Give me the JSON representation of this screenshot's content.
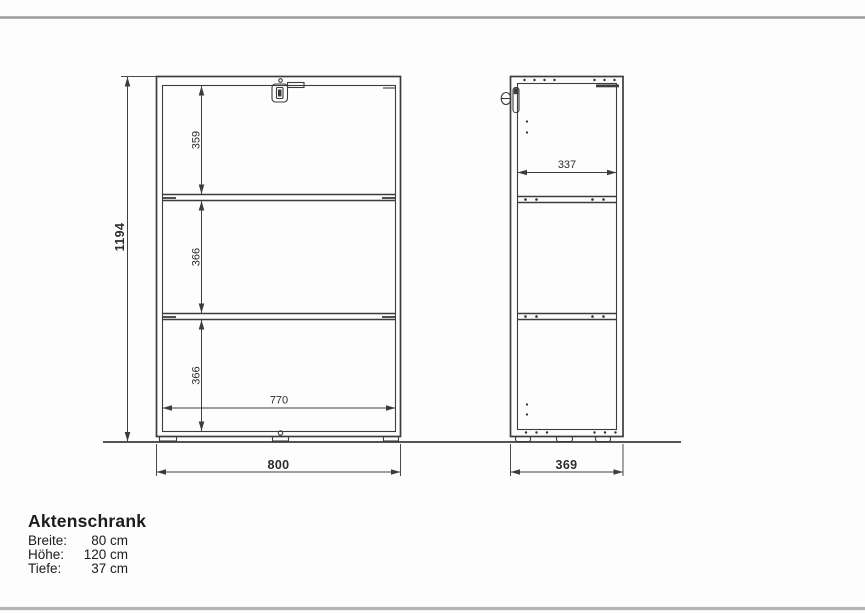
{
  "front": {
    "overall_height": "1194",
    "compartments": [
      "359",
      "366",
      "366"
    ],
    "inner_width": "770",
    "overall_width": "800"
  },
  "side": {
    "inner_depth": "337",
    "overall_depth": "369"
  },
  "product": {
    "title": "Aktenschrank",
    "specs": [
      {
        "label": "Breite:",
        "value": "80 cm"
      },
      {
        "label": "Höhe:",
        "value": "120 cm"
      },
      {
        "label": "Tiefe:",
        "value": "37 cm"
      }
    ]
  },
  "colors": {
    "drawing_line": "#3c3c3c",
    "frame_top": "#9c9c9c",
    "frame_bottom": "#b5b5b5",
    "background": "#fdfdfd"
  }
}
